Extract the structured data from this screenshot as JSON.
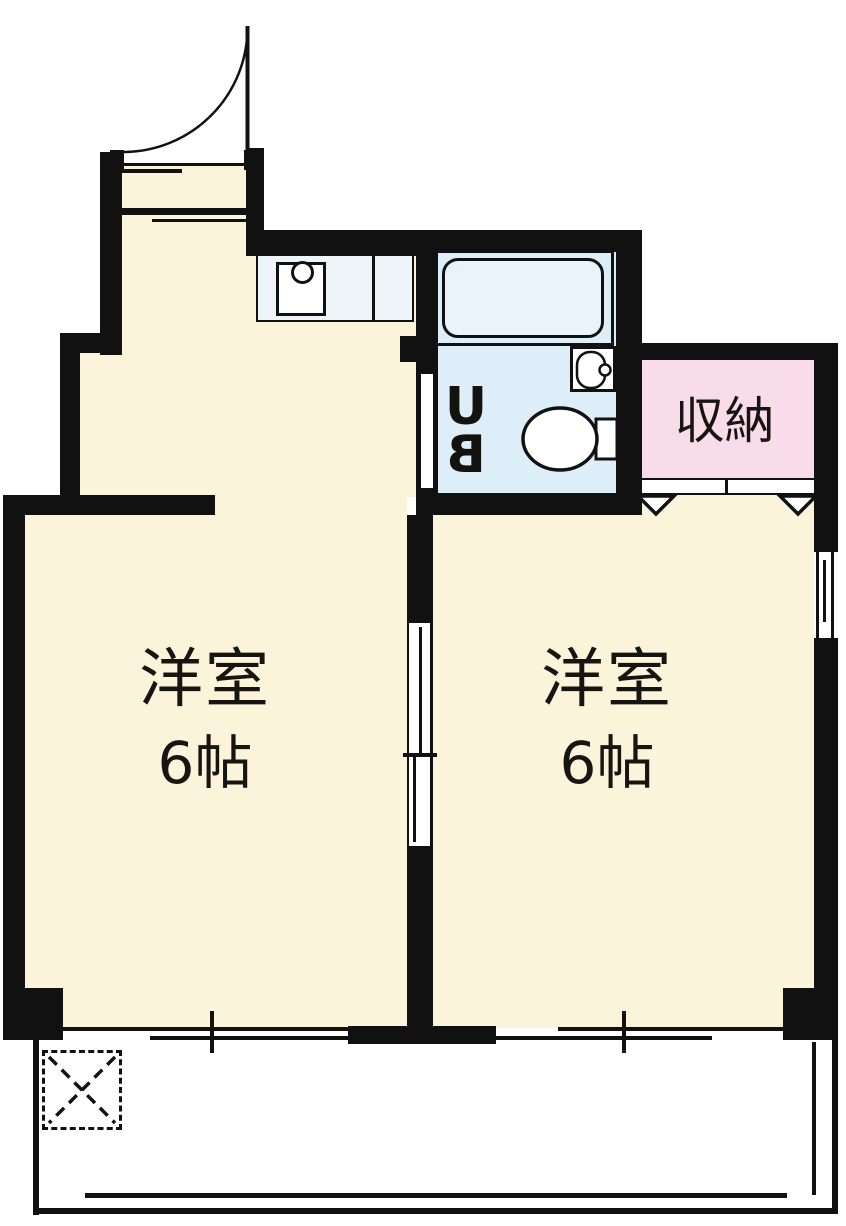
{
  "rooms": {
    "left_room": {
      "name": "洋室",
      "size": "6帖"
    },
    "right_room": {
      "name": "洋室",
      "size": "6帖"
    },
    "storage": {
      "label": "収納"
    },
    "unit_bath": {
      "letters": [
        "U",
        "B"
      ]
    }
  },
  "colors": {
    "wall": "#111111",
    "room_floor": "#fbf3da",
    "bath_floor": "#ddeef8",
    "bathtub": "#e9f3fb",
    "storage": "#f9dce9",
    "counter": "#eef5f9",
    "background": "#ffffff"
  },
  "icons": [
    "entrance-door-icon",
    "kitchen-sink-icon",
    "bathtub-icon",
    "washbasin-icon",
    "toilet-icon",
    "closet-door-icon",
    "sliding-door-icon",
    "window-icon",
    "balcony-icon",
    "outdoor-unit-space-icon"
  ]
}
